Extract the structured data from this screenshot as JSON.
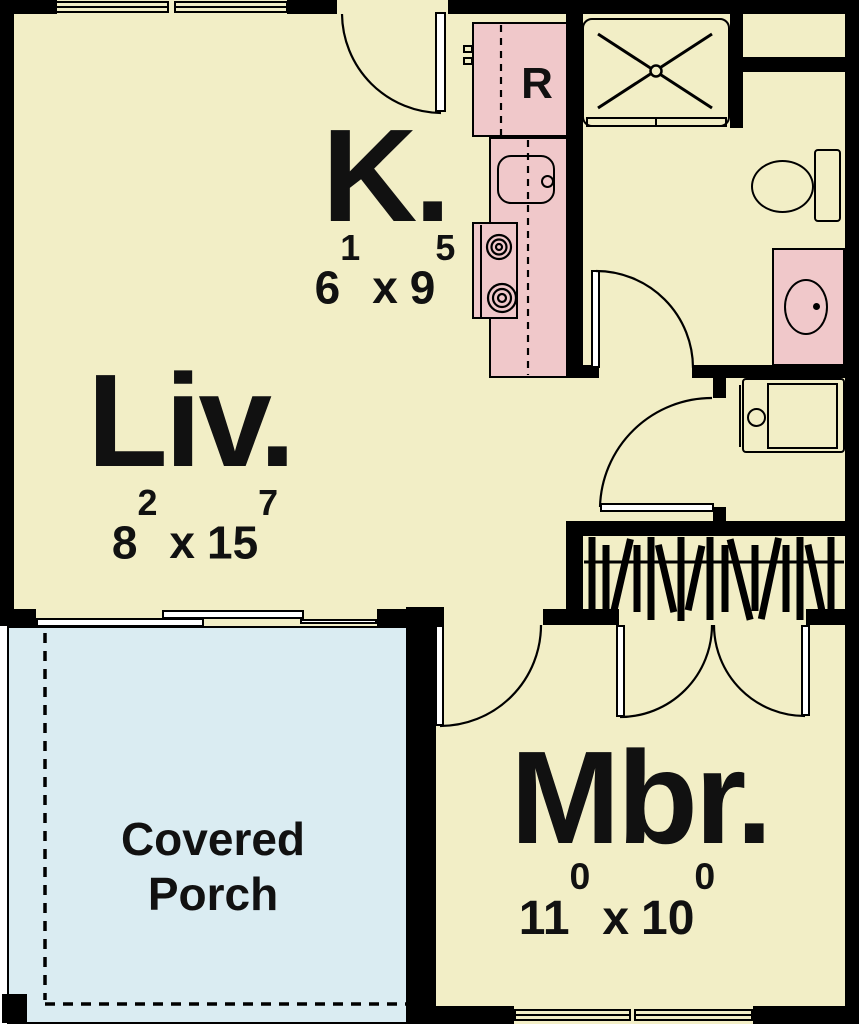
{
  "plan": {
    "colors": {
      "wall": "#000000",
      "floor": "#f2eec6",
      "fixture": "#f0c8ca",
      "porch": "#daecf2"
    },
    "rooms": [
      {
        "name": "kitchen",
        "label": "K.",
        "dim": {
          "a": "6",
          "a_sup": "1",
          "sep": "x",
          "b": "9",
          "b_sup": "5"
        }
      },
      {
        "name": "living-room",
        "label": "Liv.",
        "dim": {
          "a": "8",
          "a_sup": "2",
          "sep": "x",
          "b": "15",
          "b_sup": "7"
        }
      },
      {
        "name": "master-bedroom",
        "label": "Mbr.",
        "dim": {
          "a": "11",
          "a_sup": "0",
          "sep": "x",
          "b": "10",
          "b_sup": "0"
        }
      },
      {
        "name": "covered-porch",
        "label": "Covered Porch"
      }
    ],
    "fixtures": {
      "refrigerator_label": "R"
    }
  }
}
